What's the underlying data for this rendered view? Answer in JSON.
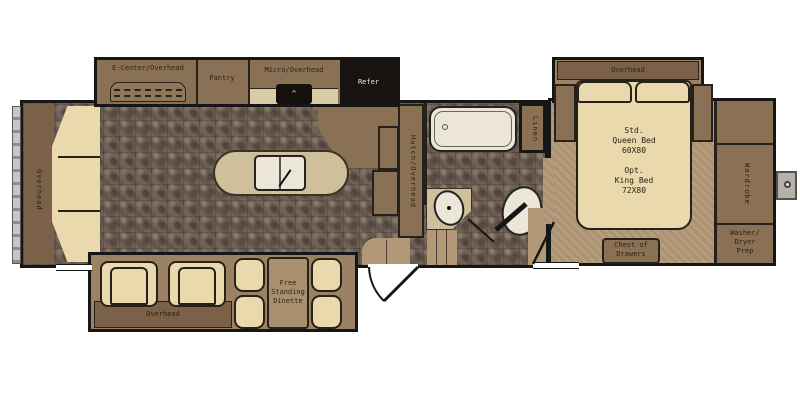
{
  "floorplan": {
    "kitchen": {
      "e_center_label": "E-Center/Overhead",
      "pantry_label": "Pantry",
      "micro_label": "Micro/Overhead",
      "refer_label": "Refer",
      "hutch_label": "Hutch/Overhead",
      "stove_glyph": "^"
    },
    "rear_lounge": {
      "overhead_label": "Overhead"
    },
    "living_slide": {
      "overhead_label": "Overhead",
      "dinette_label": "Free\nStanding\nDinette"
    },
    "bath": {
      "linen_label": "Linen"
    },
    "bedroom": {
      "overhead_label": "Overhead",
      "std_bed_label": "Std.\nQueen Bed\n60X80",
      "opt_bed_label": "Opt.\nKing Bed\n72X80",
      "chest_label": "Chest of\nDrawers",
      "wardrobe_label": "Wardrobe",
      "washer_label": "Washer/\nDryer\nPrep"
    },
    "colors": {
      "wall": "#161616",
      "cabinet": "#8a7054",
      "cabinet_dark": "#7a6148",
      "cream_furniture": "#ead9ad",
      "tile_floor": "#6e6055",
      "carpet": "#b29877",
      "fixture_white": "#ebe6d8",
      "refer_black": "#171310",
      "rail_gray": "#c6c6c4"
    }
  }
}
